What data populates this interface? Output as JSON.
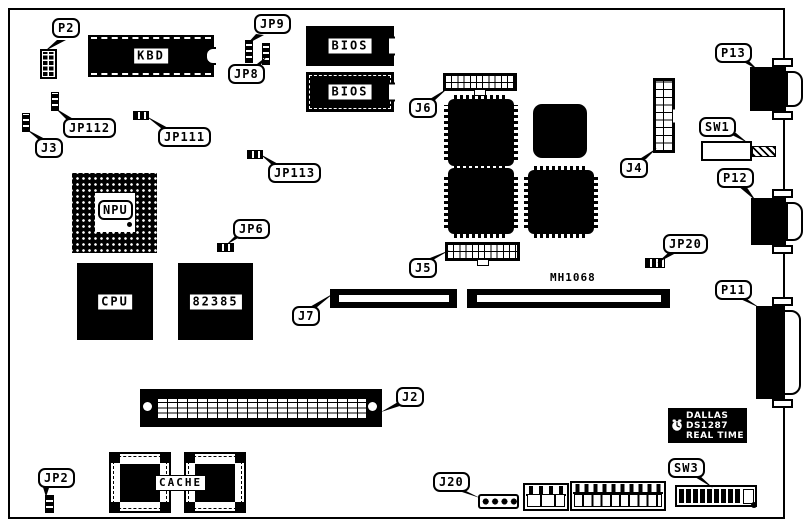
{
  "diagram": {
    "kind": "system-board-component-layout"
  },
  "colors": {
    "silkscreen": "#000000",
    "background": "#ffffff"
  },
  "callouts": {
    "p2": "P2",
    "jp9": "JP9",
    "jp8": "JP8",
    "j6": "J6",
    "j4": "J4",
    "p13": "P13",
    "sw1": "SW1",
    "p12": "P12",
    "jp20": "JP20",
    "p11": "P11",
    "j5": "J5",
    "j7": "J7",
    "j2": "J2",
    "j20": "J20",
    "sw3": "SW3",
    "jp2": "JP2",
    "j3": "J3",
    "jp112": "JP112",
    "jp111": "JP111",
    "jp113": "JP113",
    "jp6": "JP6"
  },
  "chips": {
    "kbd": "KBD",
    "bios_top": "BIOS",
    "bios_bottom": "BIOS",
    "npu": "NPU",
    "cpu": "CPU",
    "cache_ctrl": "82385",
    "cache": "CACHE",
    "mh1068": "MH1068"
  },
  "rtc": {
    "brand": "DALLAS",
    "part": "DS1287",
    "type": "REAL TIME"
  }
}
